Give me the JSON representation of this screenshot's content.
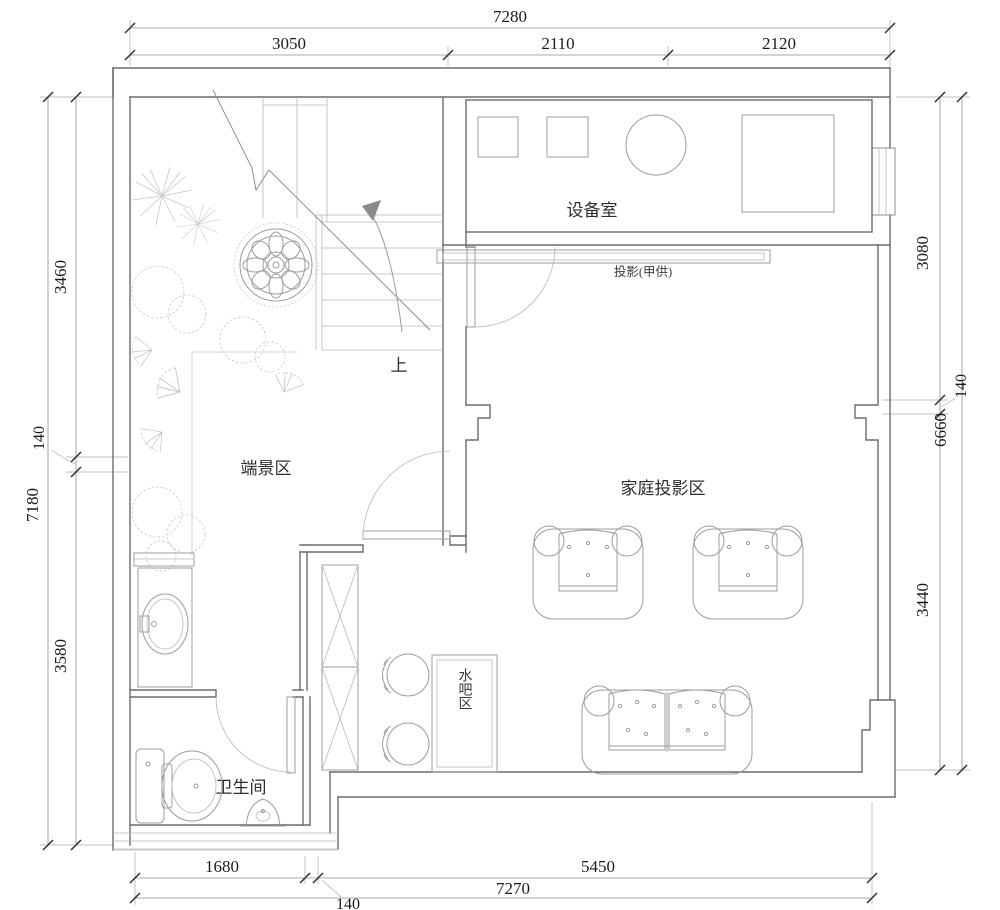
{
  "dimensions": {
    "top": {
      "total": "7280",
      "segments": [
        "3050",
        "2110",
        "2120"
      ]
    },
    "left": {
      "total": "7180",
      "segments": [
        "3460",
        "140",
        "3580"
      ]
    },
    "right": {
      "total": "6660",
      "segments": [
        "3080",
        "140",
        "3440"
      ]
    },
    "bottom": {
      "total": "7270",
      "segments": [
        "1680",
        "140",
        "5450"
      ]
    }
  },
  "labels": {
    "equipment_room": "设备室",
    "projector": "投影(甲供)",
    "end_view_area": "端景区",
    "family_projection_area": "家庭投影区",
    "water_bar_area": "水吧区",
    "bathroom": "卫生间",
    "stairs_up": "上"
  }
}
